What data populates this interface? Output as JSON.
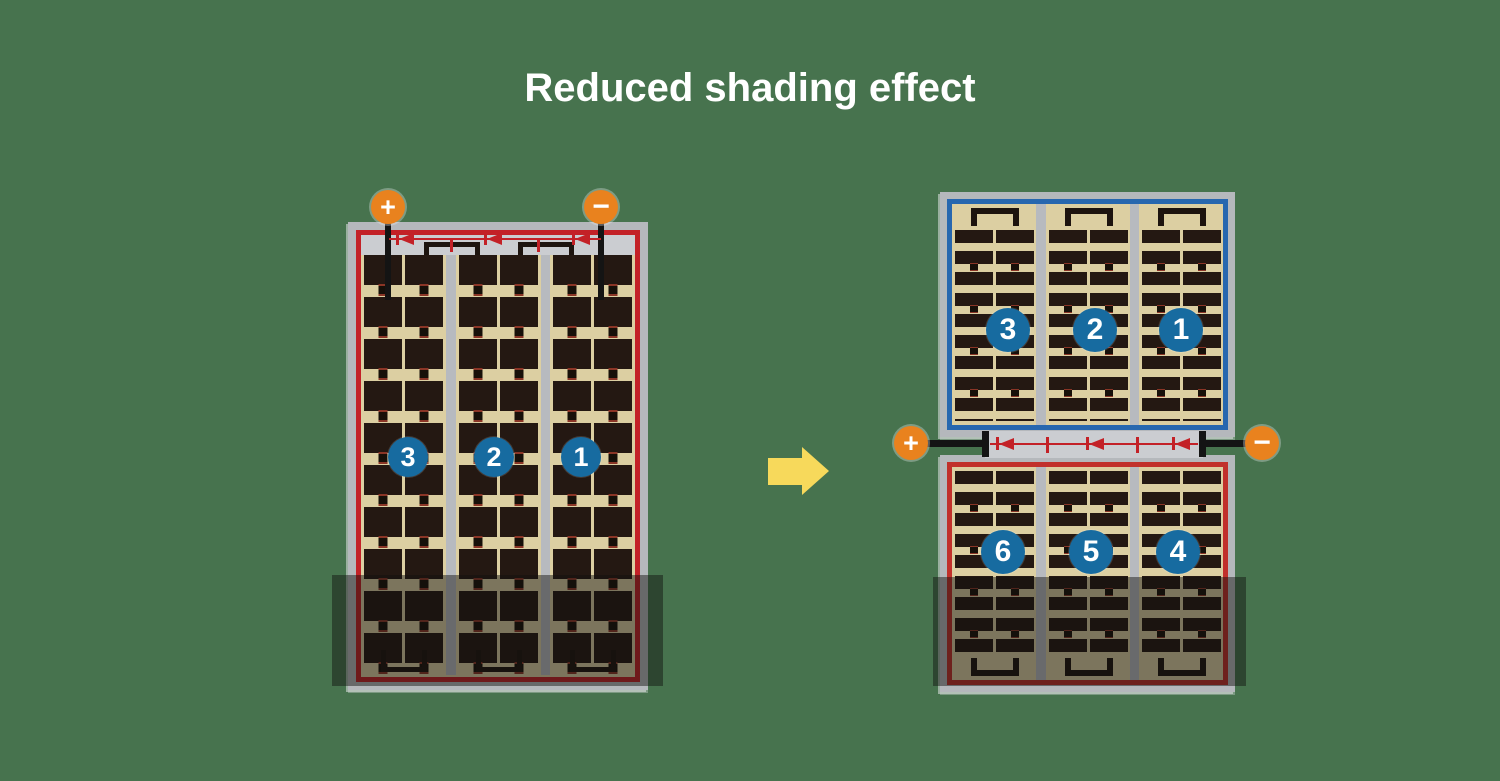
{
  "title": "Reduced shading effect",
  "before_module": {
    "terminals": {
      "positive": "+",
      "negative": "−"
    },
    "strings": [
      {
        "label": "3"
      },
      {
        "label": "2"
      },
      {
        "label": "1"
      }
    ],
    "bypass_diode_count": 3,
    "shaded_bottom": true
  },
  "after_module": {
    "terminals": {
      "positive": "+",
      "negative": "−"
    },
    "top_strings": [
      {
        "label": "3"
      },
      {
        "label": "2"
      },
      {
        "label": "1"
      }
    ],
    "bottom_strings": [
      {
        "label": "6"
      },
      {
        "label": "5"
      },
      {
        "label": "4"
      }
    ],
    "bypass_diode_count": 3,
    "shaded_bottom": true
  },
  "colors": {
    "background_green": "#47734E",
    "module_frame_gray": "#B5B8BC",
    "cell_field_tan": "#DCCFA2",
    "cell_dark": "#241812",
    "series_red": "#C32127",
    "series_blue": "#2767AF",
    "terminal_orange": "#E9821E",
    "string_badge_blue": "#176BA0",
    "arrow_yellow": "#F7D95B",
    "shade_overlay": "rgba(18,16,14,0.47)"
  }
}
